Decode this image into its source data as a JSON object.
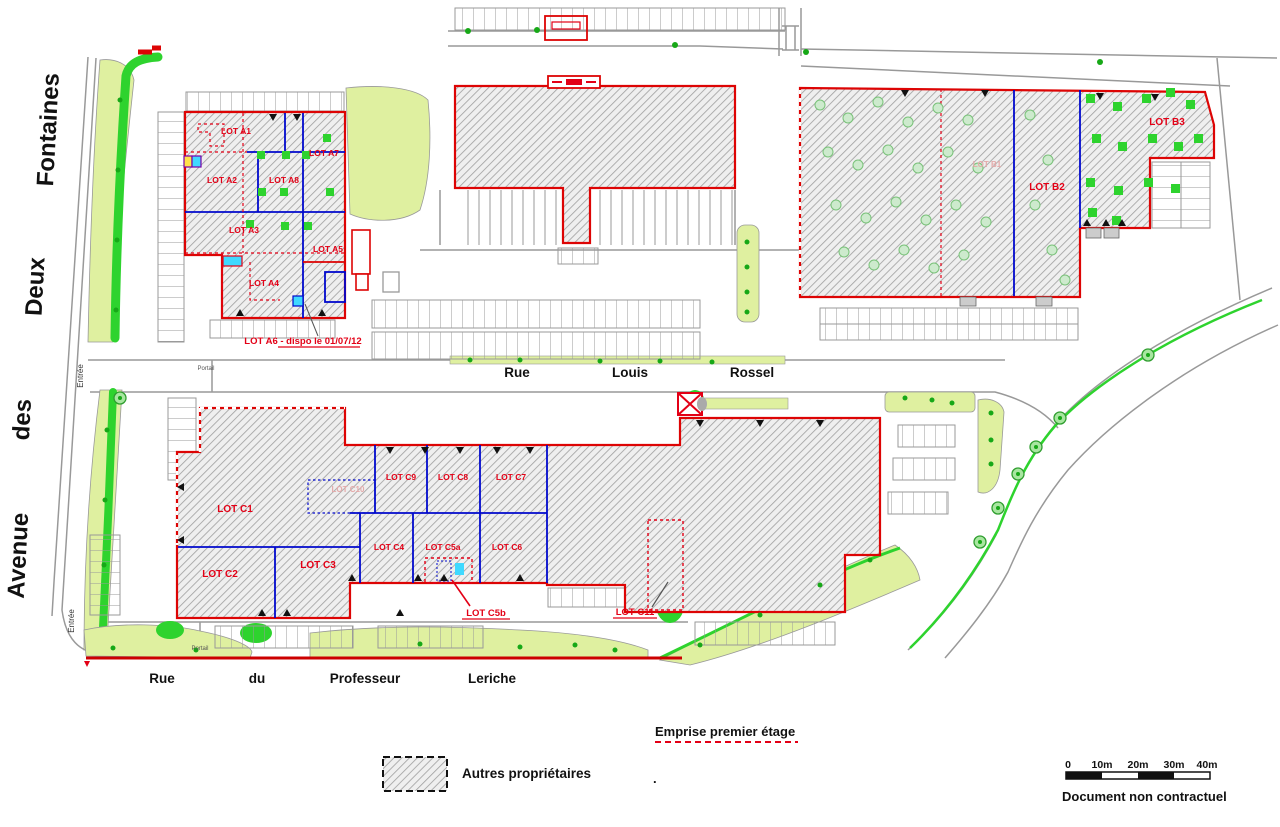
{
  "streets": {
    "avenue": {
      "w1": "Avenue",
      "w2": "des",
      "w3": "Deux",
      "w4": "Fontaines"
    },
    "rossel": {
      "w1": "Rue",
      "w2": "Louis",
      "w3": "Rossel"
    },
    "leriche": {
      "w1": "Rue",
      "w2": "du",
      "w3": "Professeur",
      "w4": "Leriche"
    },
    "entree": "Entrée",
    "portail": "Portail"
  },
  "lots": {
    "a1": "LOT A1",
    "a2": "LOT A2",
    "a3": "LOT A3",
    "a4": "LOT A4",
    "a5": "LOT A5",
    "a7": "LOT A7",
    "a8": "LOT A8",
    "a6_note": "LOT A6 - dispo le 01/07/12",
    "b1": "LOT B1",
    "b2": "LOT B2",
    "b3": "LOT B3",
    "c1": "LOT C1",
    "c2": "LOT C2",
    "c3": "LOT C3",
    "c4": "LOT C4",
    "c5a": "LOT C5a",
    "c5b": "LOT C5b",
    "c6": "LOT C6",
    "c7": "LOT C7",
    "c8": "LOT C8",
    "c9": "LOT C9",
    "c10": "LOT C10",
    "c11": "LOT C11"
  },
  "legend": {
    "autres": "Autres propriétaires",
    "emprise": "Emprise premier étage",
    "document": "Document non contractuel",
    "separator_dot": "."
  },
  "scale": {
    "t0": "0",
    "t1": "10m",
    "t2": "20m",
    "t3": "30m",
    "t4": "40m"
  },
  "colors": {
    "lot_label_red": "#e30016",
    "outline_red": "#dd0404",
    "divider_blue": "#0008cc",
    "green_bright": "#2ed32e",
    "green_pale": "#dff0a0",
    "road_gray": "#999999"
  }
}
